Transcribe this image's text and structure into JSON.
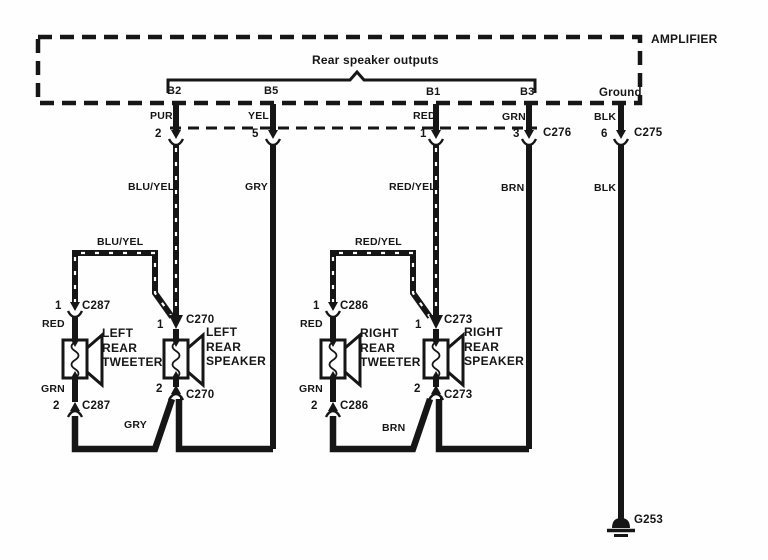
{
  "amplifier": {
    "label": "AMPLIFIER",
    "outputs_label": "Rear speaker outputs",
    "ground_label": "Ground",
    "pins": [
      {
        "id": "B2",
        "color": "PUR",
        "pin": "2",
        "harness": "BLU/YEL"
      },
      {
        "id": "B5",
        "color": "YEL",
        "pin": "5",
        "harness": "GRY"
      },
      {
        "id": "B1",
        "color": "RED",
        "pin": "1",
        "harness": "RED/YEL"
      },
      {
        "id": "B3",
        "color": "GRN",
        "pin": "3",
        "harness": "BRN"
      },
      {
        "id": "Ground",
        "color": "BLK",
        "pin": "6",
        "harness": "BLK"
      }
    ],
    "connectors": {
      "main": "C276",
      "ground": "C275"
    }
  },
  "left_tweeter": {
    "line1": "LEFT",
    "line2": "REAR",
    "line3": "TWEETER",
    "connector": "C287",
    "pin_top": "1",
    "pin_bottom": "2",
    "wire_in": "RED",
    "wire_out": "GRN",
    "branch": "BLU/YEL"
  },
  "left_speaker": {
    "line1": "LEFT",
    "line2": "REAR",
    "line3": "SPEAKER",
    "connector": "C270",
    "pin_top": "1",
    "pin_bottom": "2",
    "return_wire": "GRY"
  },
  "right_tweeter": {
    "line1": "RIGHT",
    "line2": "REAR",
    "line3": "TWEETER",
    "connector": "C286",
    "pin_top": "1",
    "pin_bottom": "2",
    "wire_in": "RED",
    "wire_out": "GRN",
    "branch": "RED/YEL"
  },
  "right_speaker": {
    "line1": "RIGHT",
    "line2": "REAR",
    "line3": "SPEAKER",
    "connector": "C273",
    "pin_top": "1",
    "pin_bottom": "2",
    "return_wire": "BRN"
  },
  "ground": {
    "id": "G253"
  }
}
